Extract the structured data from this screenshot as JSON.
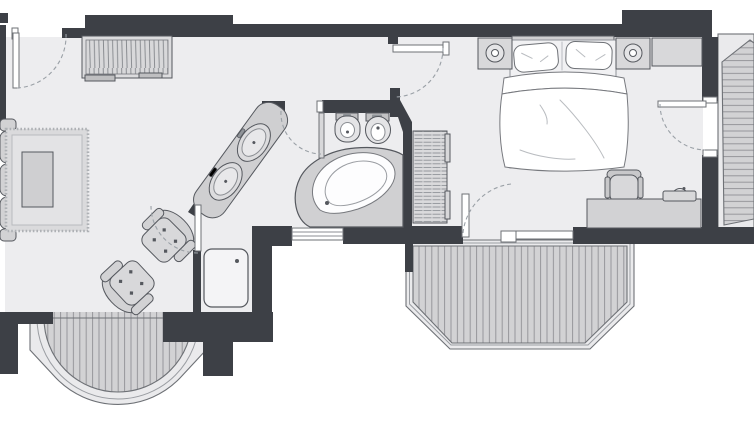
{
  "colors": {
    "background": "#ffffff",
    "wall": "#3d4046",
    "floor": "#ededef",
    "deck": "#d2d2d4",
    "deck_stripe": "#96969b",
    "railing_band": "#eaeaec",
    "furniture_fill": "#d6d6d8",
    "furniture_stroke": "#55585e",
    "linen_white": "#ffffff",
    "door_arc": "#9aa0a6"
  },
  "plan": {
    "type": "apartment-floor-plan",
    "rooms": [
      {
        "id": "living-room",
        "items": [
          "sofa",
          "rug",
          "coffee-table",
          "armchair",
          "armchair",
          "wardrobe",
          "entrance-door"
        ]
      },
      {
        "id": "bathroom",
        "items": [
          "vanity-two-washbasins",
          "bidet",
          "toilet",
          "corner-bathtub",
          "shower",
          "radiator",
          "bathroom-door",
          "shower-door",
          "window"
        ]
      },
      {
        "id": "bedroom",
        "items": [
          "double-bed",
          "pillow",
          "pillow",
          "duvet",
          "nightstand-lamp",
          "nightstand-lamp",
          "dresser",
          "desk",
          "desk-chair",
          "tray",
          "hall-door",
          "balcony-door",
          "balcony-door"
        ]
      },
      {
        "id": "balcony-semicircular",
        "items": [
          "plank-decking",
          "railing"
        ]
      },
      {
        "id": "balcony-polygonal",
        "items": [
          "plank-decking",
          "railing"
        ]
      },
      {
        "id": "balcony-side",
        "items": [
          "plank-decking",
          "railing"
        ]
      }
    ],
    "door_count": 6,
    "window_count": 2
  }
}
